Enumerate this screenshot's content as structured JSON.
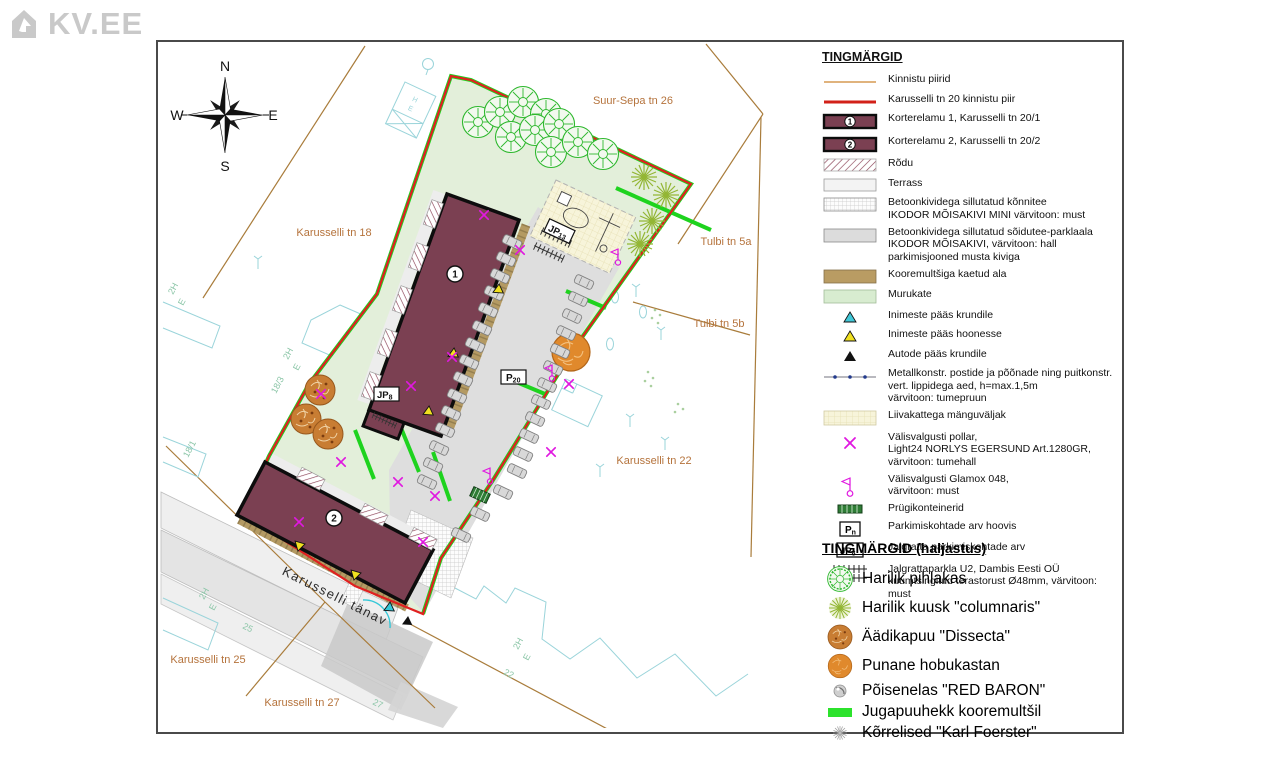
{
  "watermark": {
    "text": "KV.EE"
  },
  "compass": {
    "north": "N",
    "south": "S",
    "east": "E",
    "west": "W"
  },
  "plan": {
    "street_labels": [
      "Suur-Sepa tn 26",
      "Karusselli tn 18",
      "Tulbi tn 5a",
      "Tulbi tn 5b",
      "Karusselli tn 22",
      "Karusselli tn 25",
      "Karusselli tn 27"
    ],
    "street_name_rotated": "Karusselli tänav",
    "building1_badge": "1",
    "building2_badge": "2",
    "parking_label": {
      "main": "P",
      "sub": "20"
    },
    "bike_label_yard": {
      "main": "JP",
      "sub": "8"
    },
    "bike_label_north": {
      "main": "JP",
      "sub": "13"
    },
    "cadastral_labels": [
      "2H",
      "E",
      "18/3",
      "2H",
      "E",
      "18/1",
      "25",
      "27",
      "2H",
      "E",
      "22",
      "2H",
      "E",
      "H",
      "E"
    ]
  },
  "legend": {
    "title": "TINGMÄRGID",
    "items": [
      {
        "symbol": "line-tan",
        "lines": [
          "Kinnistu piirid"
        ]
      },
      {
        "symbol": "line-red",
        "lines": [
          "Karusselli tn 20 kinnistu piir"
        ]
      },
      {
        "symbol": "building",
        "badge": "1",
        "lines": [
          "Korterelamu 1, Karusselli tn 20/1"
        ]
      },
      {
        "symbol": "building",
        "badge": "2",
        "lines": [
          "Korterelamu 2, Karusselli tn 20/2"
        ]
      },
      {
        "symbol": "hatch",
        "lines": [
          "Rõdu"
        ]
      },
      {
        "symbol": "terrace",
        "lines": [
          "Terrass"
        ]
      },
      {
        "symbol": "grid",
        "lines": [
          "Betoonkividega sillutatud kõnnitee",
          "IKODOR MÕISAKIVI MINI värvitoon: must"
        ]
      },
      {
        "symbol": "gray",
        "lines": [
          "Betoonkividega sillutatud sõidutee-parklaala",
          "IKODOR MÕISAKIVI, värvitoon: hall",
          "parkimisjooned musta kiviga"
        ]
      },
      {
        "symbol": "mulch",
        "lines": [
          "Kooremultšiga kaetud ala"
        ]
      },
      {
        "symbol": "grass",
        "lines": [
          "Murukate"
        ]
      },
      {
        "symbol": "tri-cyan",
        "lines": [
          "Inimeste pääs krundile"
        ]
      },
      {
        "symbol": "tri-yellow",
        "lines": [
          "Inimeste pääs hoonesse"
        ]
      },
      {
        "symbol": "tri-black",
        "lines": [
          "Autode pääs krundile"
        ]
      },
      {
        "symbol": "fence",
        "lines": [
          "Metallkonstr. postide ja põõnade ning puitkonstr.",
          "vert. lippidega aed, h=max.1,5m",
          "värvitoon: tumepruun"
        ]
      },
      {
        "symbol": "sand",
        "lines": [
          "Liivakattega mänguväljak"
        ]
      },
      {
        "symbol": "pollar",
        "lines": [
          "Välisvalgusti pollar,",
          "Light24 NORLYS EGERSUND Art.1280GR,",
          "värvitoon: tumehall"
        ]
      },
      {
        "symbol": "glamox",
        "lines": [
          "Välisvalgusti Glamox 048,",
          "värvitoon: must"
        ]
      },
      {
        "symbol": "trash",
        "lines": [
          "Prügikonteinerid"
        ]
      },
      {
        "symbol": "pn-box",
        "badge_main": "P",
        "badge_sub": "n",
        "lines": [
          "Parkimiskohtade arv hoovis"
        ]
      },
      {
        "symbol": "jp-box",
        "badge_main": "JP",
        "badge_sub": "8",
        "lines": [
          "Jalgratta parkimiskohtade arv"
        ]
      },
      {
        "symbol": "rack",
        "lines": [
          "Jalgrattaparkla U2, Dambis Eesti OÜ",
          "kuumtsingitud terastorust Ø48mm, värvitoon: must"
        ]
      }
    ]
  },
  "legend_haljastus": {
    "title": "TINGMÄRGID (haljastus)",
    "items": [
      {
        "symbol": "tree-green",
        "label": "Harilik pihlakas"
      },
      {
        "symbol": "tree-star",
        "label": "Harilik kuusk \"columnaris\""
      },
      {
        "symbol": "tree-brown",
        "label": "Äädikapuu \"Dissecta\""
      },
      {
        "symbol": "tree-orange",
        "label": "Punane hobukastan"
      },
      {
        "symbol": "shrub-gray",
        "label": "Põisenelas \"RED BARON\""
      },
      {
        "symbol": "hedge-green",
        "label": "Jugapuuhekk kooremultšil"
      },
      {
        "symbol": "grass-aster",
        "label": "Kõrrelised \"Karl Foerster\""
      }
    ]
  },
  "colors": {
    "building": "#7b4052",
    "boundary_red": "#e02020",
    "hedge_green": "#1ed31e",
    "lawn": "#e3efda",
    "parking": "#dedede",
    "mulch": "#b49a63",
    "magenta": "#e018e0",
    "sand": "#f7f4da",
    "base_cyan": "#9ad4da",
    "label_brown": "#b5733c",
    "parcel_line": "#a97c3b",
    "watermark_gray": "#c9c9c9"
  }
}
